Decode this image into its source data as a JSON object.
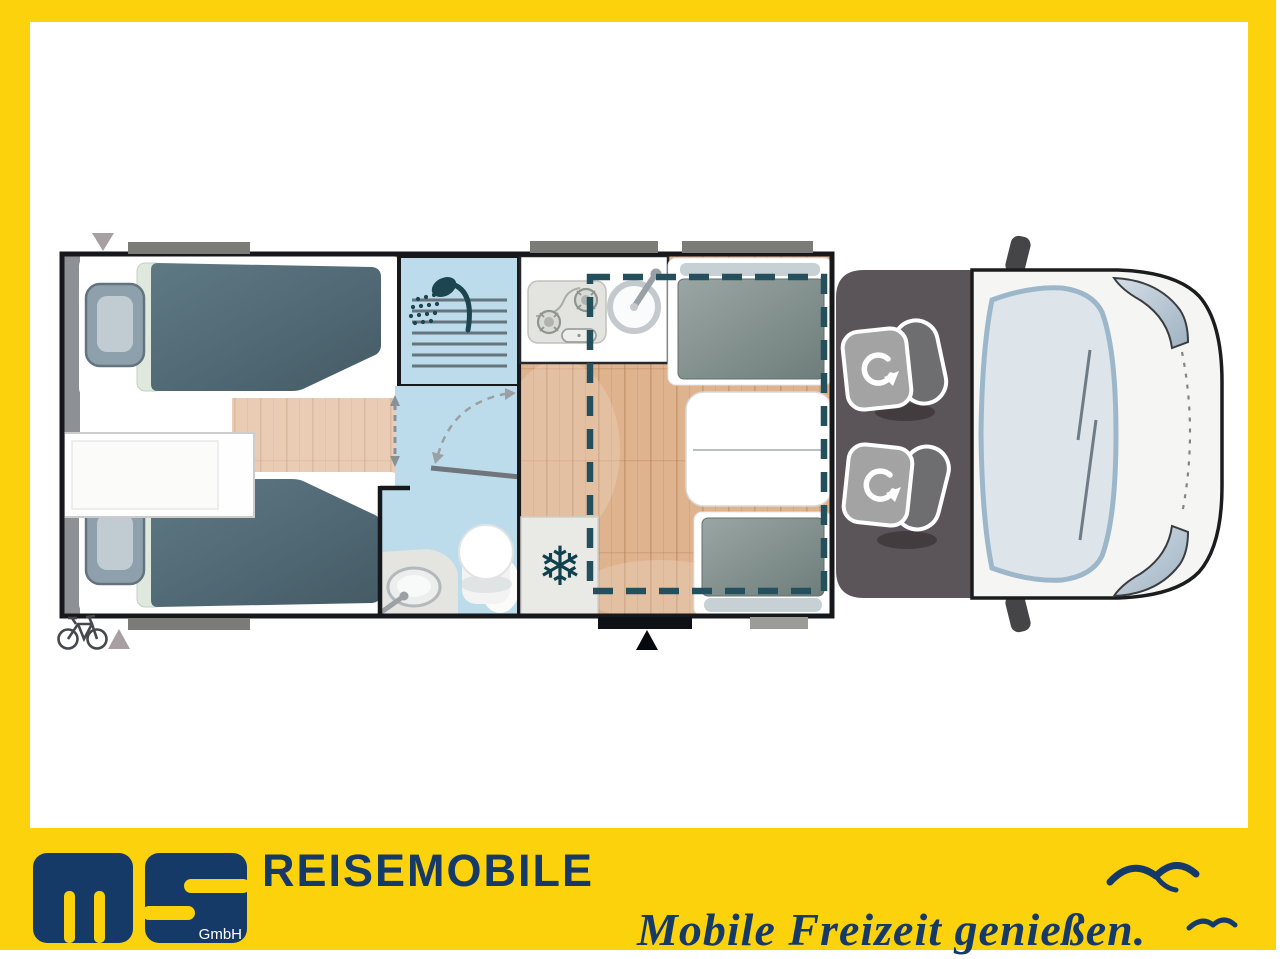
{
  "branding": {
    "logo_text": "ms",
    "logo_subtext": "GmbH",
    "wordmark": "REISEMOBILE",
    "tagline": "Mobile Freizeit genießen."
  },
  "colors": {
    "frame_yellow": "#FCD20D",
    "brand_navy": "#163A68",
    "plan_wall_black": "#17181C",
    "wet_room_blue": "#BCDCEC",
    "drop_down_bed_dash_teal": "#23505C",
    "wood_floor": "#DFB38E",
    "mattress_slate": "#4E6773",
    "cab_floor_gray": "#5B5458",
    "window_bar_gray": "#7B7B78",
    "cushion_gray": "#7F8D8B",
    "headrest_gray": "#C7D1D5",
    "vehicle_body_white": "#F5F5F4",
    "windshield_blue": "#DDE4EA"
  },
  "icons": [
    "shower-icon",
    "snowflake-icon",
    "bicycle-icon",
    "swivel-seat-arrow-icon",
    "entry-arrow-icon",
    "window-marker-triangle-icon",
    "door-swing-arc-icon",
    "seagull-icon-large",
    "seagull-icon-small"
  ]
}
